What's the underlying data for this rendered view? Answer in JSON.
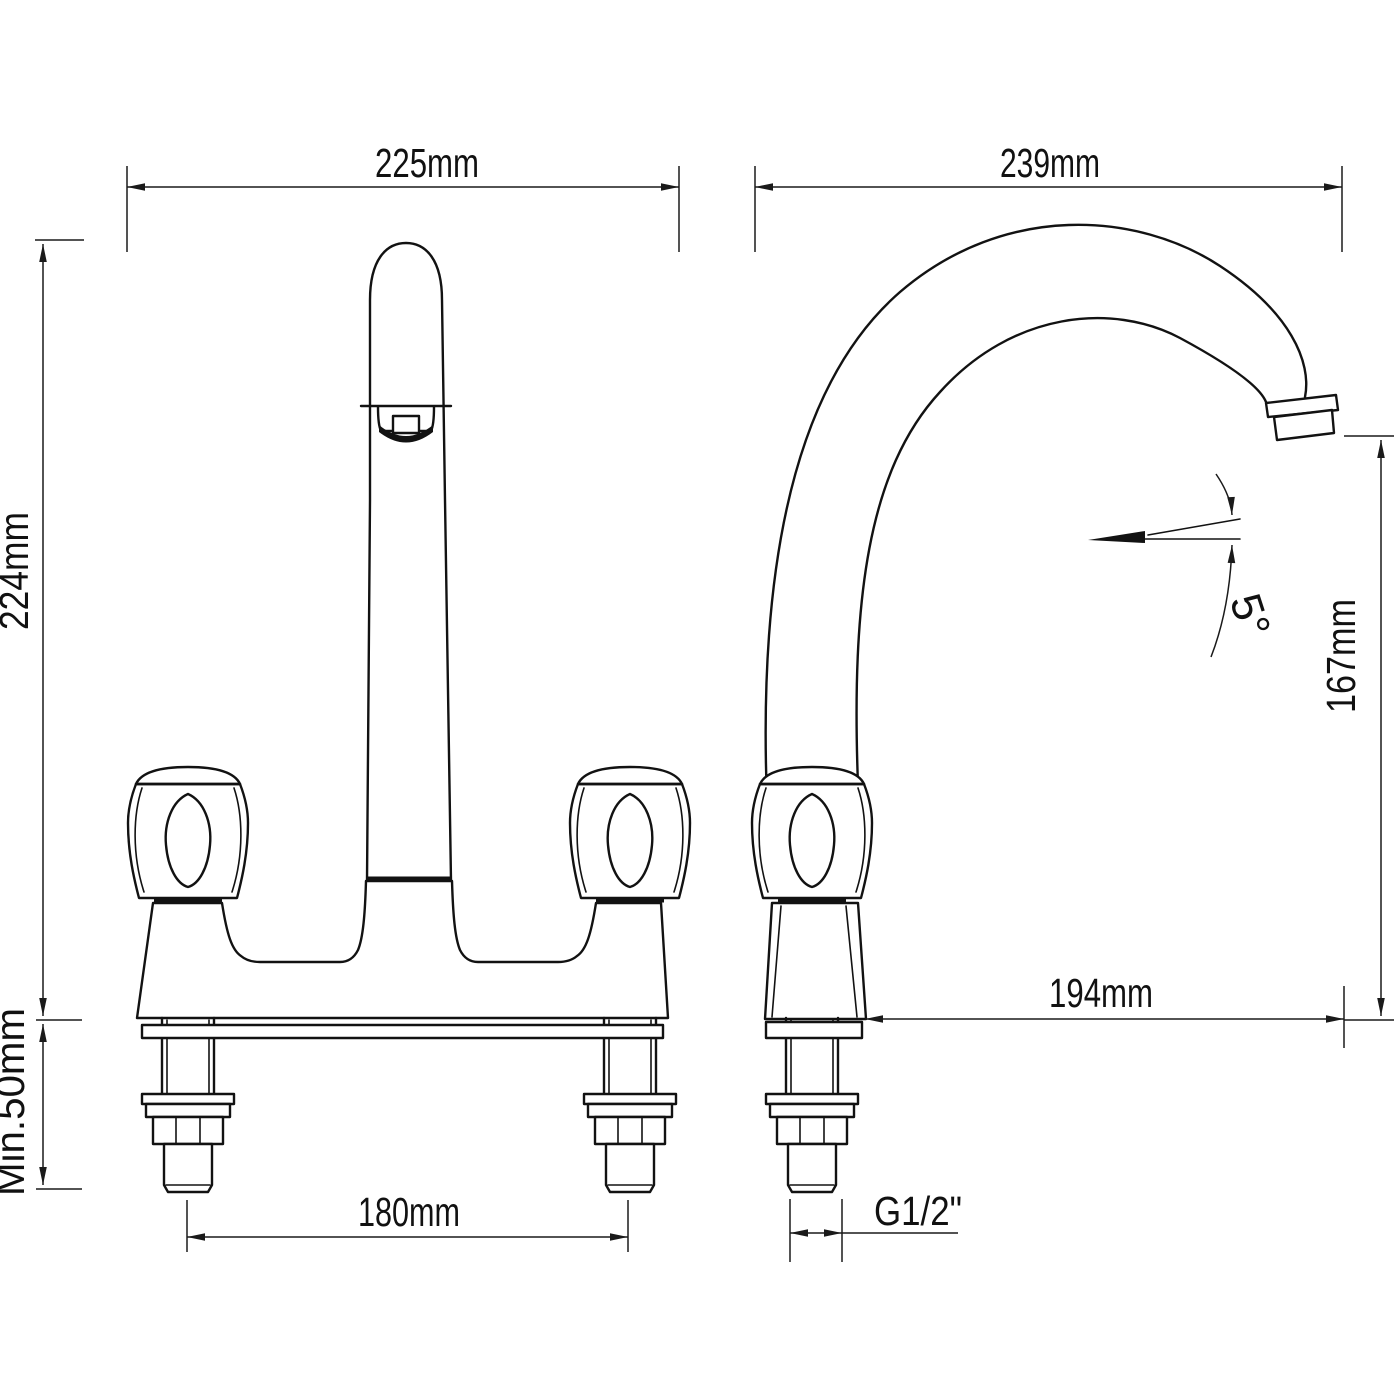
{
  "drawing": {
    "type": "faucet-technical-dimension-drawing",
    "line_color": "#121212",
    "background": "#ffffff"
  },
  "dimensions": {
    "front_width": "225mm",
    "side_depth": "239mm",
    "total_height": "224mm",
    "min_counter_thickness": "Min.50mm",
    "inlet_spacing": "180mm",
    "spout_reach": "194mm",
    "spout_outlet_height": "167mm",
    "spout_angle": "5°",
    "thread_size": "G1/2\""
  }
}
